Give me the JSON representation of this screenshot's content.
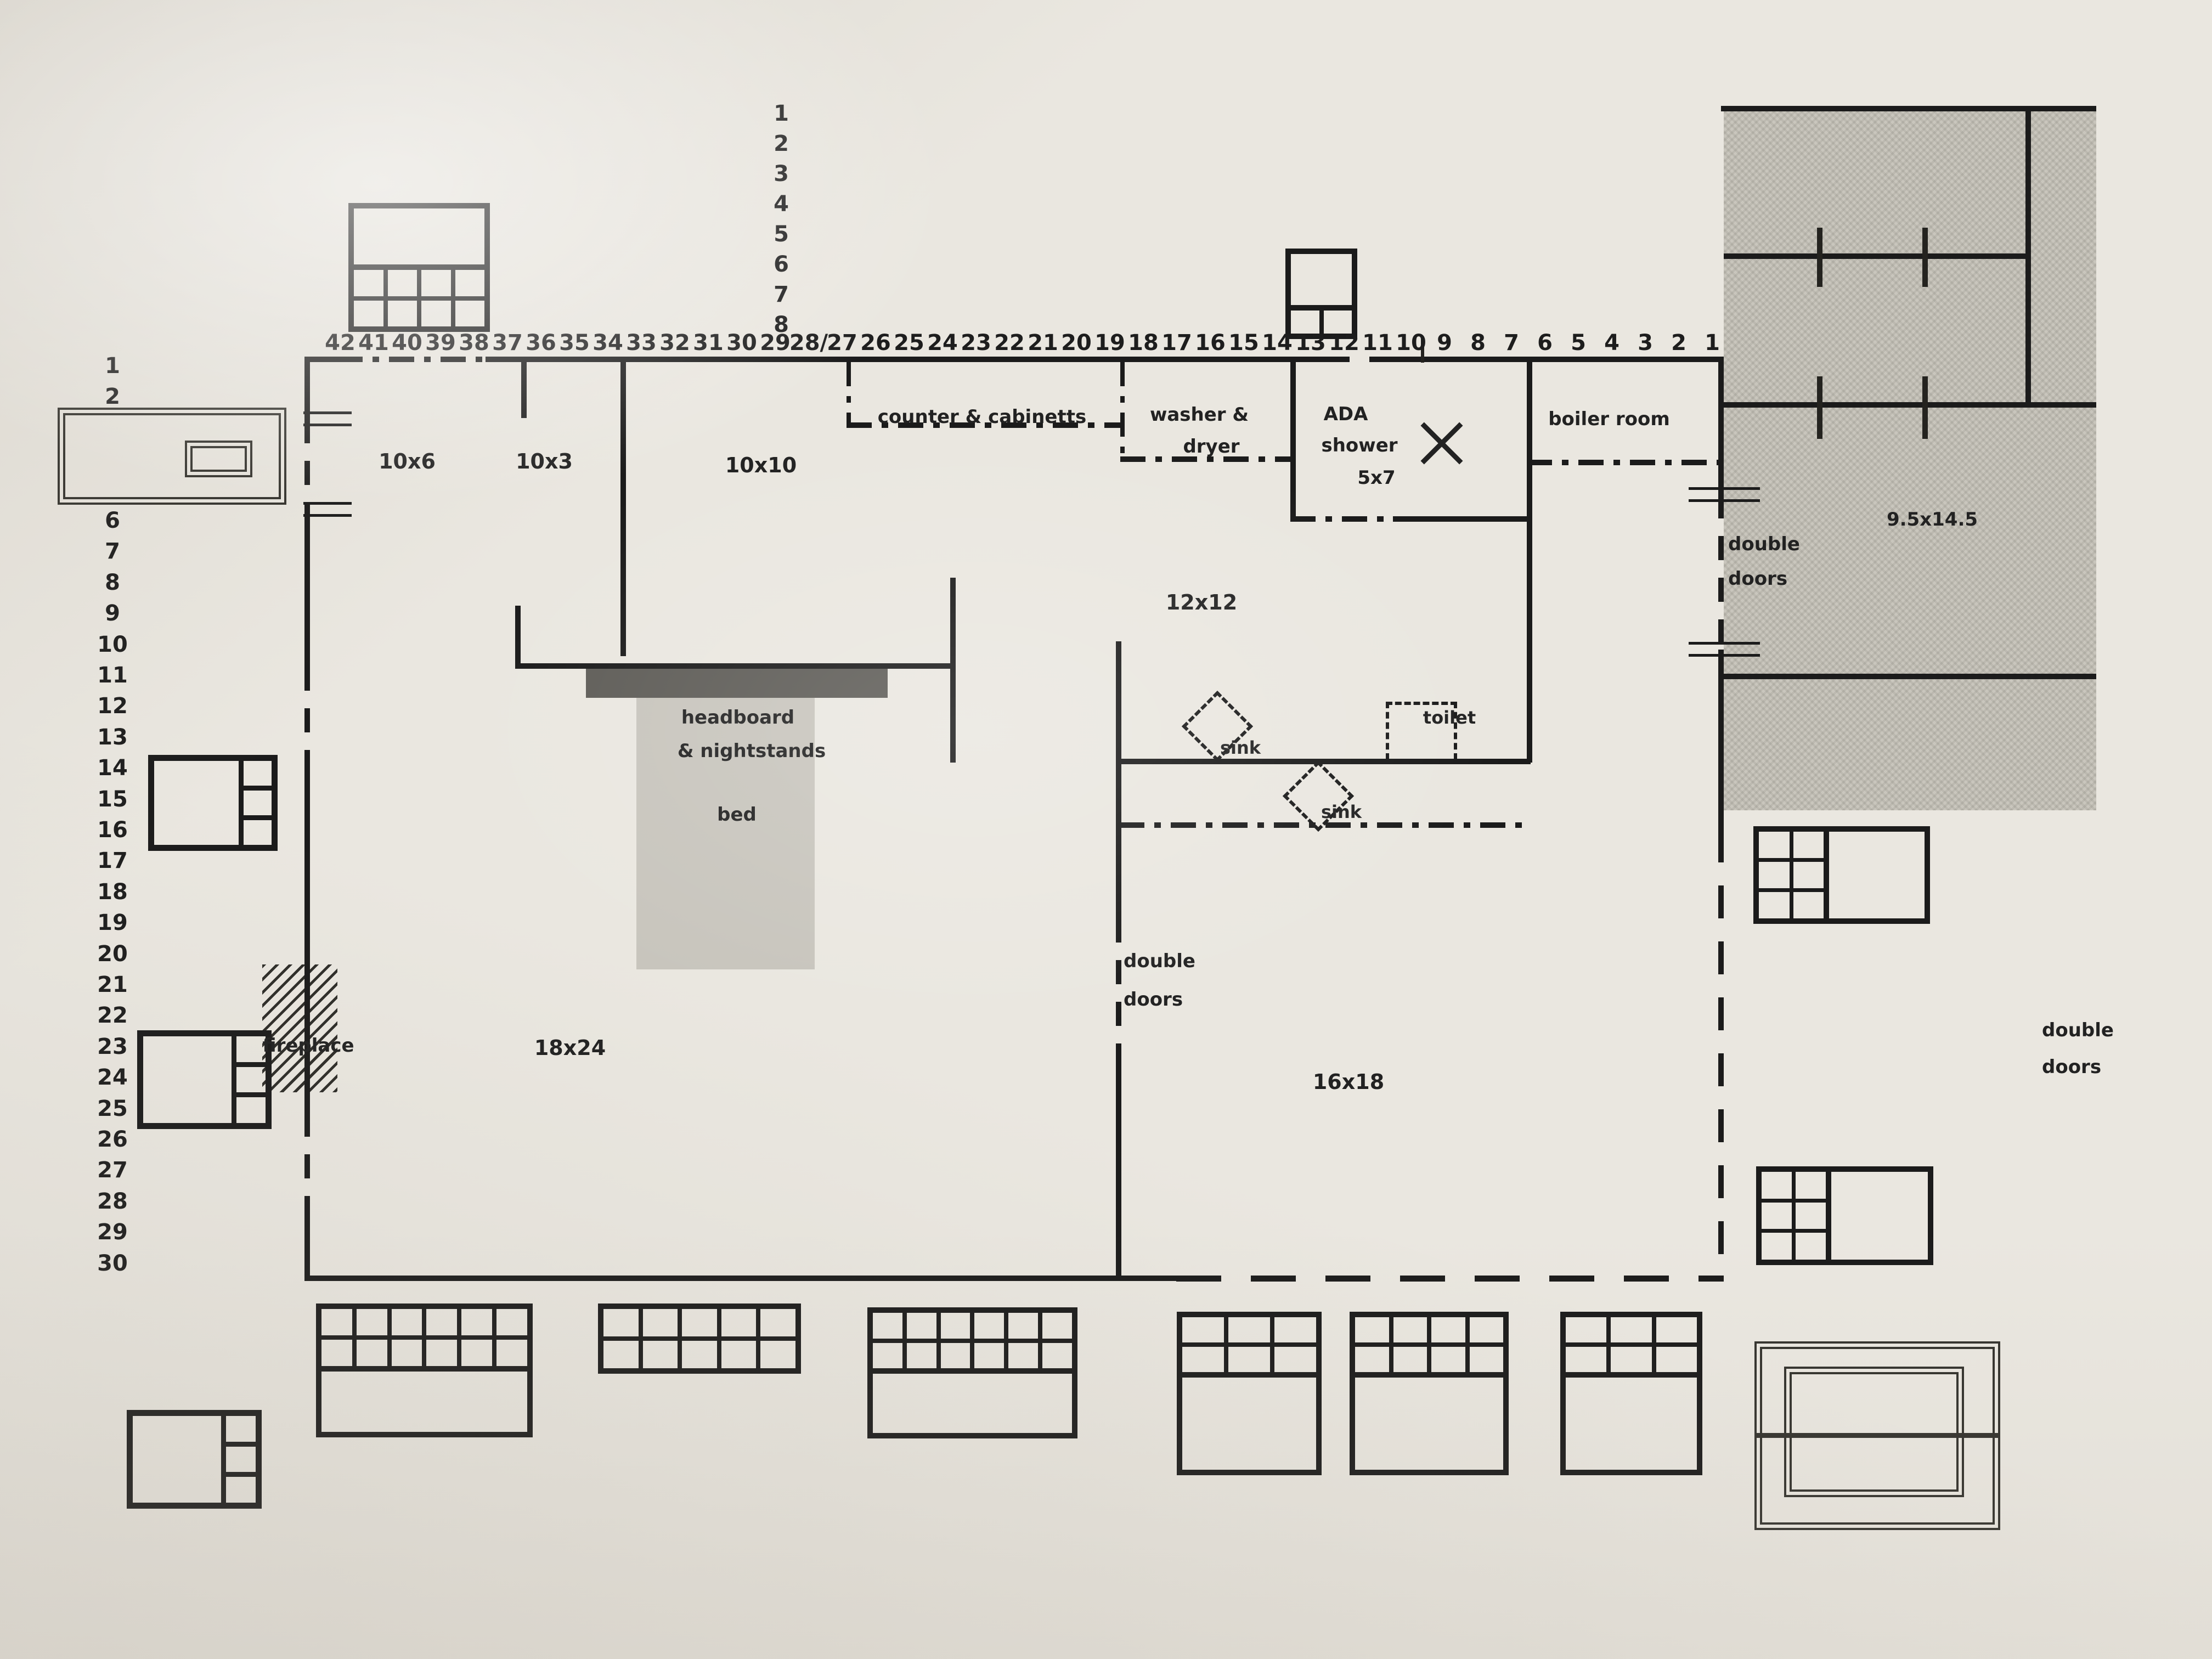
{
  "document": {
    "kind": "hand-drafted floor plan sketch on paper"
  },
  "colors": {
    "paper": "#eae7e0",
    "ink": "#1b1b1b",
    "gray_room_fill": "#c9c6bd",
    "headboard_fill": "#5e5c57",
    "bed_fill": "#c8c5bd"
  },
  "rulers": {
    "top": [
      "42",
      "41",
      "40",
      "39",
      "38",
      "37",
      "36",
      "35",
      "34",
      "33",
      "32",
      "31",
      "30",
      "29",
      "28/",
      "27",
      "26",
      "25",
      "24",
      "23",
      "22",
      "21",
      "20",
      "19",
      "18",
      "17",
      "16",
      "15",
      "14",
      "13",
      "12",
      "11",
      "10",
      "9",
      "8",
      "7",
      "6",
      "5",
      "4",
      "3",
      "2",
      "1"
    ],
    "top_vertical": [
      "1",
      "2",
      "3",
      "4",
      "5",
      "6",
      "7",
      "8"
    ],
    "left": [
      "1",
      "2",
      "6",
      "7",
      "8",
      "9",
      "10",
      "11",
      "12",
      "13",
      "14",
      "15",
      "16",
      "17",
      "18",
      "19",
      "20",
      "21",
      "22",
      "23",
      "24",
      "25",
      "26",
      "27",
      "28",
      "29",
      "30"
    ]
  },
  "rooms": {
    "r10x6": "10x6",
    "r10x3": "10x3",
    "r10x10": "10x10",
    "r12x12": "12x12",
    "r16x18": "16x18",
    "r18x24": "18x24",
    "r95x145": "9.5x14.5"
  },
  "labels": {
    "counter": "counter & cabinetts",
    "washer_line1": "washer &",
    "washer_line2": "dryer",
    "ada_line1": "ADA",
    "ada_line2": "shower",
    "ada_line3": "5x7",
    "boiler": "boiler room",
    "headboard_line1": "headboard",
    "headboard_line2": "& nightstands",
    "bed": "bed",
    "sink": "sink",
    "toilet": "toilet",
    "fireplace": "fireplace",
    "double": "double",
    "doors": "doors"
  }
}
